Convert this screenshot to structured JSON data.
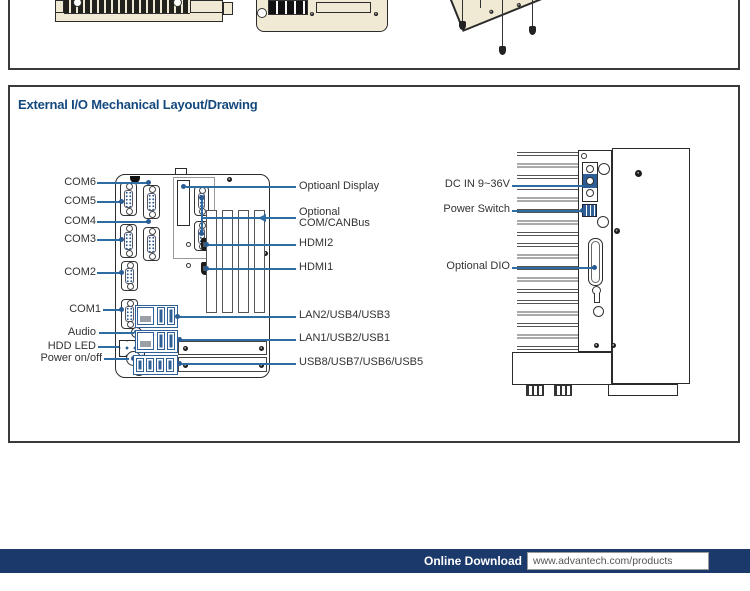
{
  "section": {
    "title": "External I/O Mechanical Layout/Drawing"
  },
  "front_view": {
    "left_labels": [
      "COM6",
      "COM5",
      "COM4",
      "COM3",
      "COM2",
      "COM1",
      "Audio",
      "HDD LED",
      "Power on/off"
    ],
    "right_labels": [
      "Optioanl Display",
      "Optional COM/CANBus",
      "HDMI2",
      "HDMI1",
      "LAN2/USB4/USB3",
      "LAN1/USB2/USB1",
      "USB8/USB7/USB6/USB5"
    ]
  },
  "side_view": {
    "labels": [
      "DC IN 9~36V",
      "Power Switch",
      "Optional DIO"
    ]
  },
  "footer": {
    "download_label": "Online Download",
    "url": "www.advantech.com/products"
  },
  "colors": {
    "title_blue": "#15497e",
    "leader_blue": "#2e6da4",
    "port_blue": "#2e5f96",
    "footer_navy": "#1b3a6b",
    "device_beige": "#f0e9d3"
  }
}
